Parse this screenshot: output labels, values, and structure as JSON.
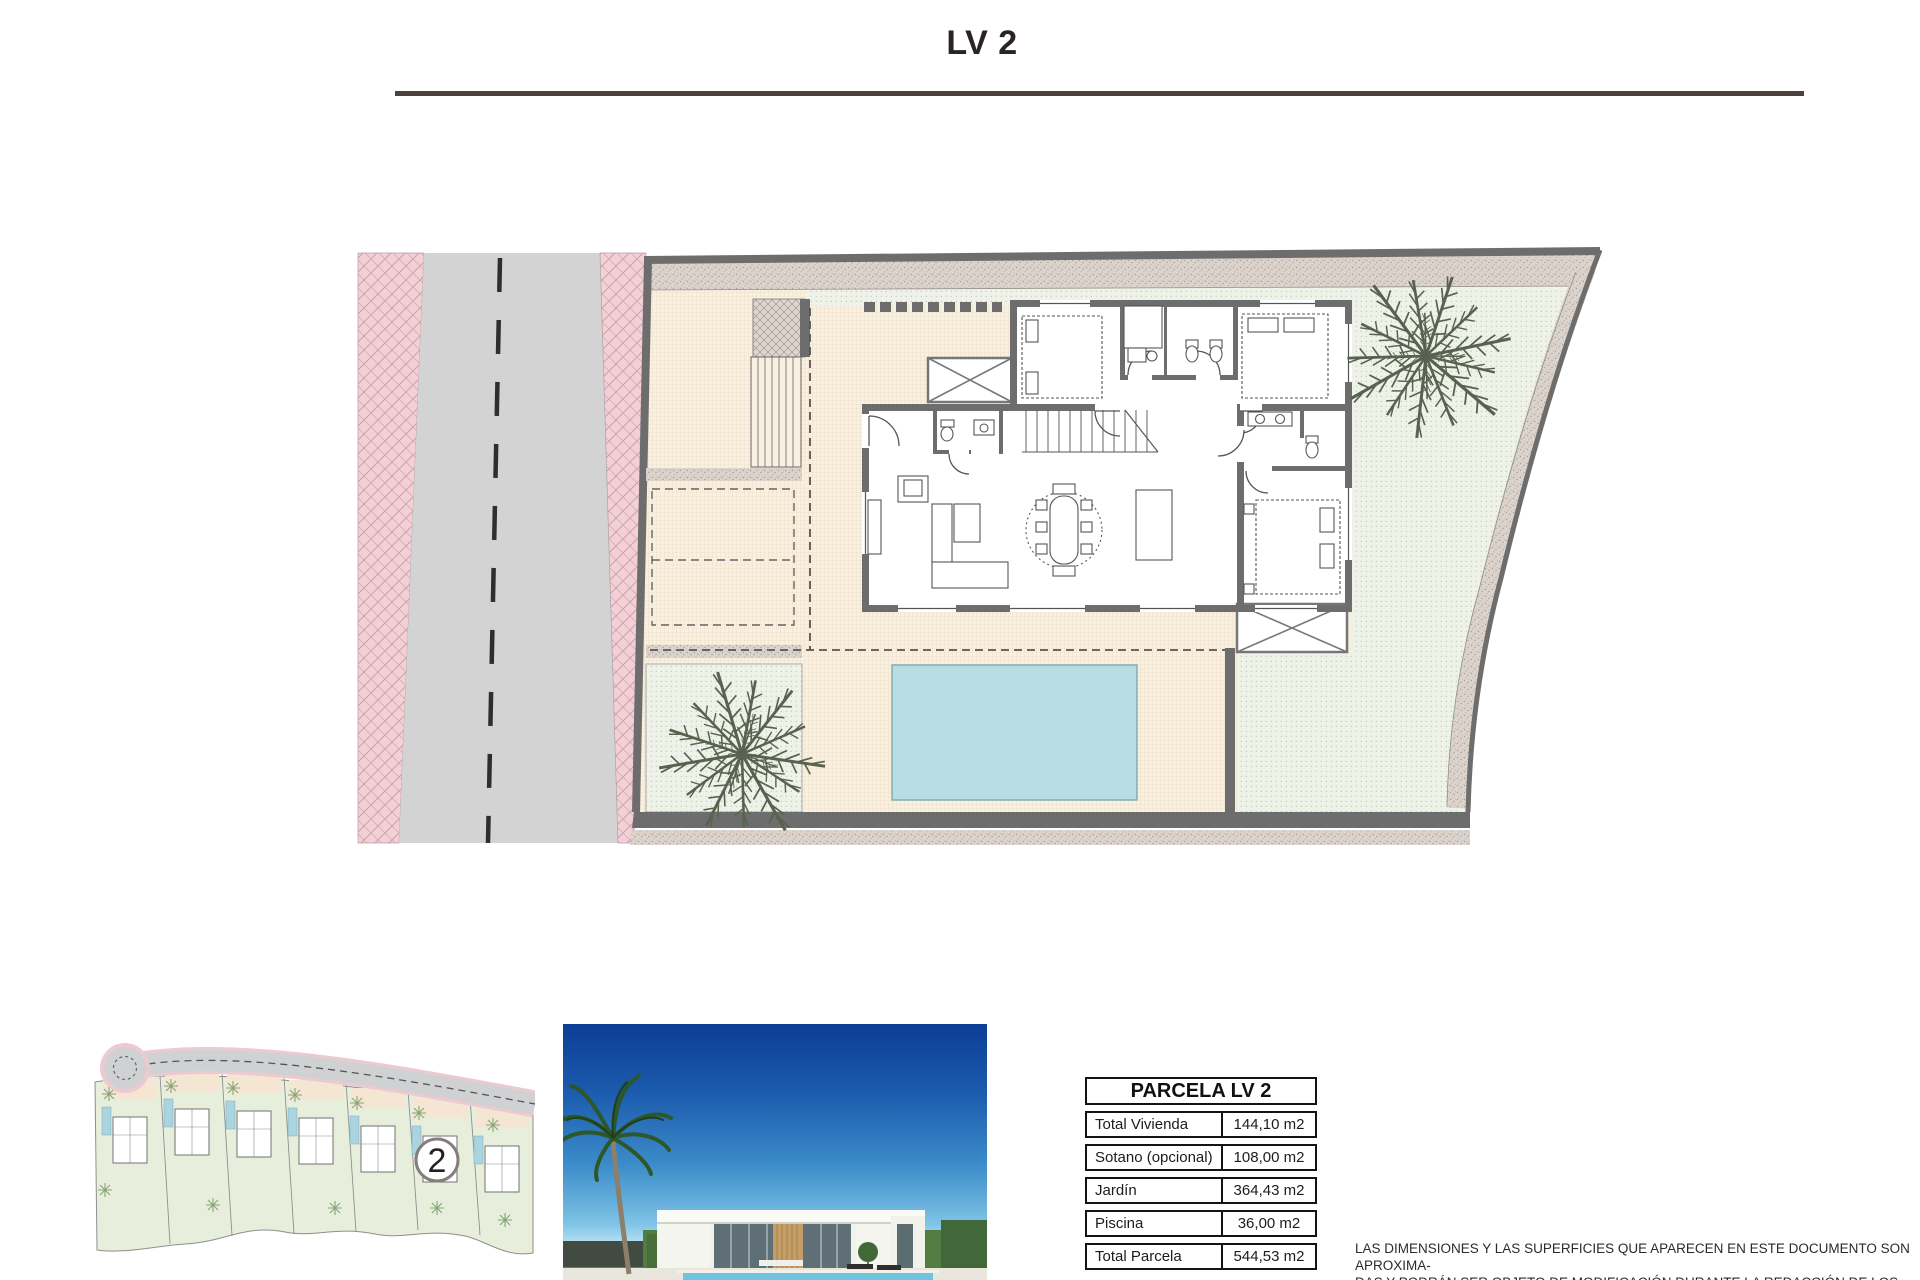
{
  "page": {
    "title": "LV 2"
  },
  "parcel_table": {
    "header": "PARCELA LV 2",
    "rows": [
      {
        "label": "Total Vivienda",
        "value": "144,10 m2"
      },
      {
        "label": "Sotano (opcional)",
        "value": "108,00 m2"
      },
      {
        "label": "Jardín",
        "value": "364,43 m2"
      },
      {
        "label": "Piscina",
        "value": "36,00 m2"
      },
      {
        "label": "Total Parcela",
        "value": "544,53 m2"
      }
    ]
  },
  "overview": {
    "plot_number": "2"
  },
  "disclaimer": {
    "line1": "LAS DIMENSIONES Y LAS SUPERFICIES QUE APARECEN EN ESTE DOCUMENTO SON APROXIMA-",
    "line2": "DAS Y PODRÁN SER OBJETO DE MODIFICACIÓN DURANTE LA REDACCIÓN DE LOS PROYECTOS",
    "line3": "BÁSICO Y DE EJECUCIÓN"
  },
  "colors": {
    "pool_blue": "#b7dde2",
    "garden_green": "#eef2e9",
    "terrace_cream": "#f8f0e1",
    "sidewalk_pink": "#f3d0d6",
    "road_gray": "#d2d3d2",
    "wall_gray": "#6d6d6d"
  }
}
